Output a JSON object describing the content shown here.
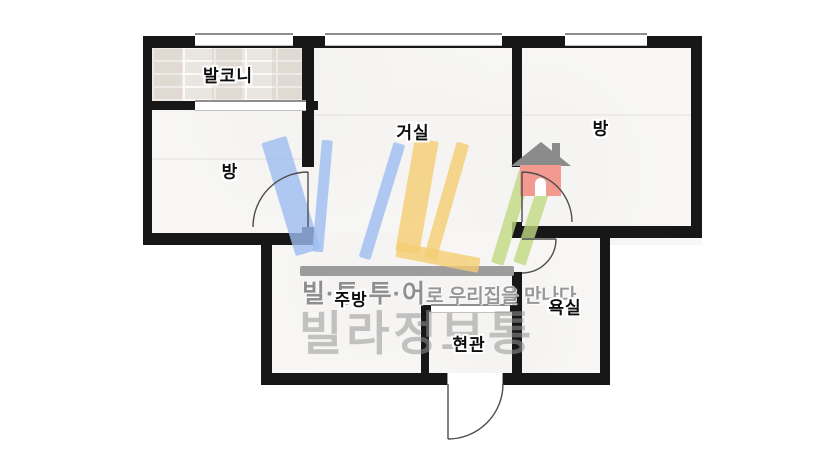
{
  "floorplan": {
    "rooms": {
      "balcony": {
        "label": "발코니"
      },
      "room_left": {
        "label": "방"
      },
      "living": {
        "label": "거실"
      },
      "room_right": {
        "label": "방"
      },
      "kitchen": {
        "label": "주방"
      },
      "entrance": {
        "label": "현관"
      },
      "bathroom": {
        "label": "욕실"
      }
    },
    "wall_color": "#171717",
    "door_line_color": "#4d4d4d",
    "window_color": "#ffffff"
  },
  "watermark": {
    "logo_text": "VIL",
    "tagline_brand": "빌·투·투·어",
    "tagline_rest": "로 우리집을 만나다",
    "brand_name": "빌라정보통",
    "colors": {
      "blue": "#9dbdf0",
      "yellow": "#f5cd72",
      "green": "#c0da81",
      "house_body": "#f29a90",
      "house_roof": "#8b8b8b",
      "underline_bar": "#9c9c9c",
      "tagline_text": "#8f8f8f",
      "brand_text": "#969696"
    }
  }
}
